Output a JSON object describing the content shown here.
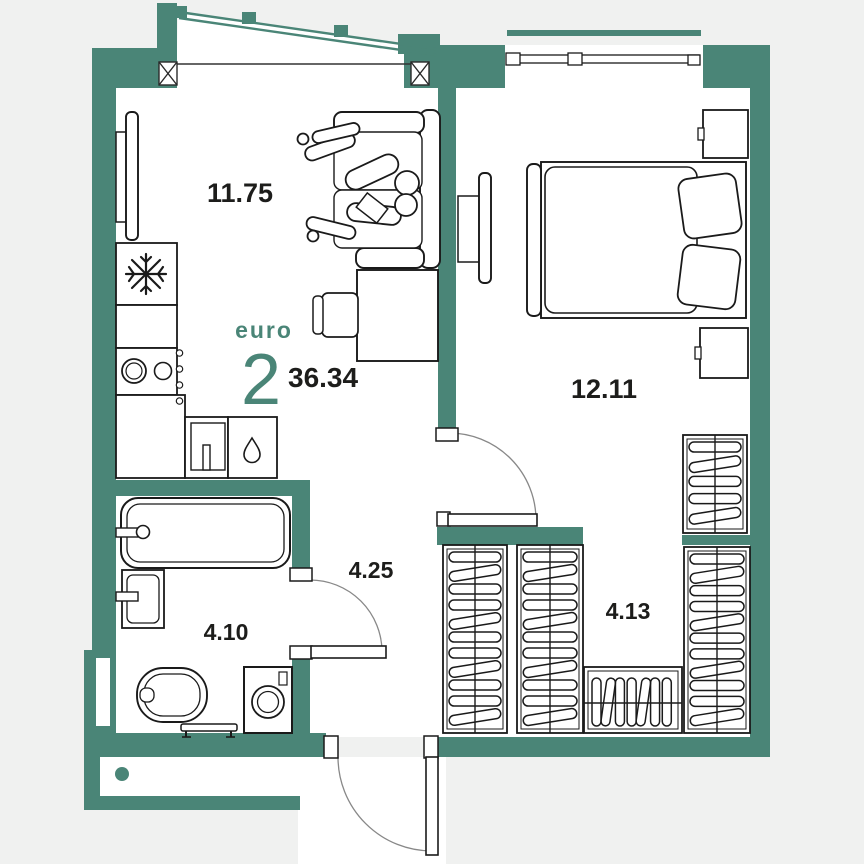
{
  "unit": {
    "format_label": "euro",
    "rooms_count": "2",
    "total_area": "36.34"
  },
  "rooms": [
    {
      "id": "living-kitchen",
      "area": "11.75"
    },
    {
      "id": "bedroom",
      "area": "12.11"
    },
    {
      "id": "hallway",
      "area": "4.25"
    },
    {
      "id": "bathroom",
      "area": "4.10"
    },
    {
      "id": "dressing-room",
      "area": "4.13"
    }
  ],
  "icons": {
    "fridge": "snowflake-icon",
    "kitchen_unit": "droplet-icon"
  },
  "colors": {
    "wall": "#4a8577",
    "floor": "#ffffff",
    "background": "#f0f1f0",
    "accent_text": "#4a8577",
    "label_text": "#1d1d1b",
    "furniture_line": "#1a1a1a"
  }
}
